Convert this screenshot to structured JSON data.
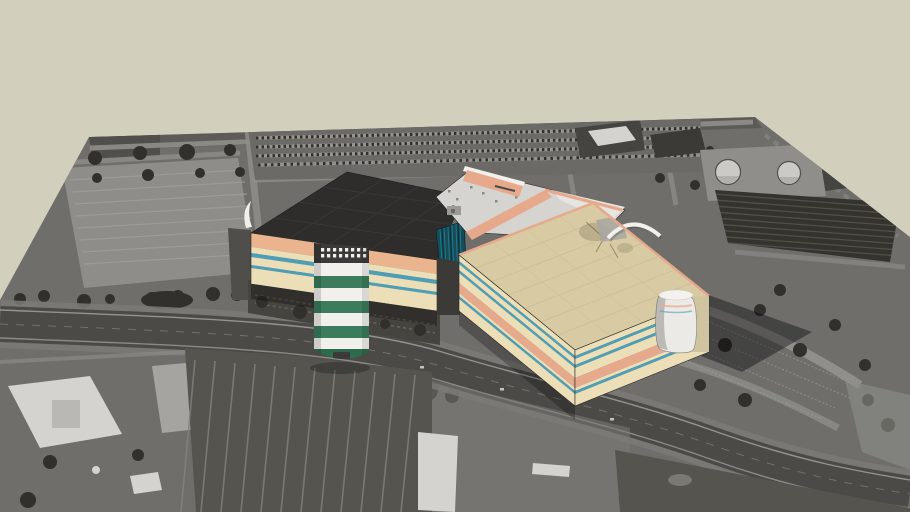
{
  "scene": {
    "type": "3d-model-viewport",
    "description": "Textured 3D shopping-mall model composited on a grayscale aerial photograph ground plane with plain beige sky background",
    "model_parts": [
      {
        "name": "west-anchor-building",
        "roof": "dark charcoal flat roof",
        "walls": "cream with peach band and two teal pinstripes"
      },
      {
        "name": "entrance-drum-tower",
        "style": "white cylinder with green stripes, dark window band on top"
      },
      {
        "name": "curtain-wall-glass",
        "style": "dark teal glazing with vertical mullions"
      },
      {
        "name": "center-building",
        "roof": "light gray with salmon parapet"
      },
      {
        "name": "east-anchor-building",
        "roof": "tan flat roof",
        "walls": "cream with salmon band and teal pinstripes"
      },
      {
        "name": "corner-cylinder-tower",
        "style": "white quarter cylinder at east corner"
      }
    ]
  },
  "colors": {
    "beige": "#d2d0bc",
    "photoBase": "#6f6e6b",
    "photoTop": "#5c5b58",
    "cornerDark": "#514f4c",
    "lotLight": "#8e8d89",
    "lotMid": "#6b6a67",
    "lotDark": "#55544f",
    "stripeLine": "#83827d",
    "rowLine": "#a2a19c",
    "street": "#8f8e8a",
    "asphalt": "#4b4a47",
    "shoulder": "#7b7a76",
    "laneLine": "#a6a5a1",
    "centerLine": "#8b8a86",
    "tree": "#31302c",
    "orchard": "#34332e",
    "orchardRow": "#55544c",
    "whiteRoof": "#d5d4d1",
    "whiteBldg": "#d4d3d0",
    "lightPatch": "#a5a4a1",
    "tank": "#cbcac7",
    "tankPad": "#8f8e8b",
    "darkGround": "#45443f",
    "darkBlock": "#454441",
    "gapDark": "#3b3a36",
    "roofDark": "#2e2d2b",
    "roofSeam": "#3b3a37",
    "cream": "#ecdfb8",
    "creamShade": "#cfc3a0",
    "peach": "#eab58e",
    "salmon": "#e7a98b",
    "teal": "#4d9fb8",
    "glass": "#174b58",
    "glassLine": "#1f8193",
    "glassDark": "#0d2a31",
    "green": "#3a7c5c",
    "greenDark": "#2e6b4d",
    "towerDark": "#3b3a38",
    "white": "#f1f0ed",
    "grayRoof": "#d5d4d1",
    "vent": "#8a8986",
    "patchGray": "#a8a7a3",
    "tanRoof": "#d8caa2",
    "tanSeam": "#c9bc95",
    "cylWhite": "#eceae6",
    "edge": "#2b2a28",
    "carDot": "#c5c4c0"
  }
}
